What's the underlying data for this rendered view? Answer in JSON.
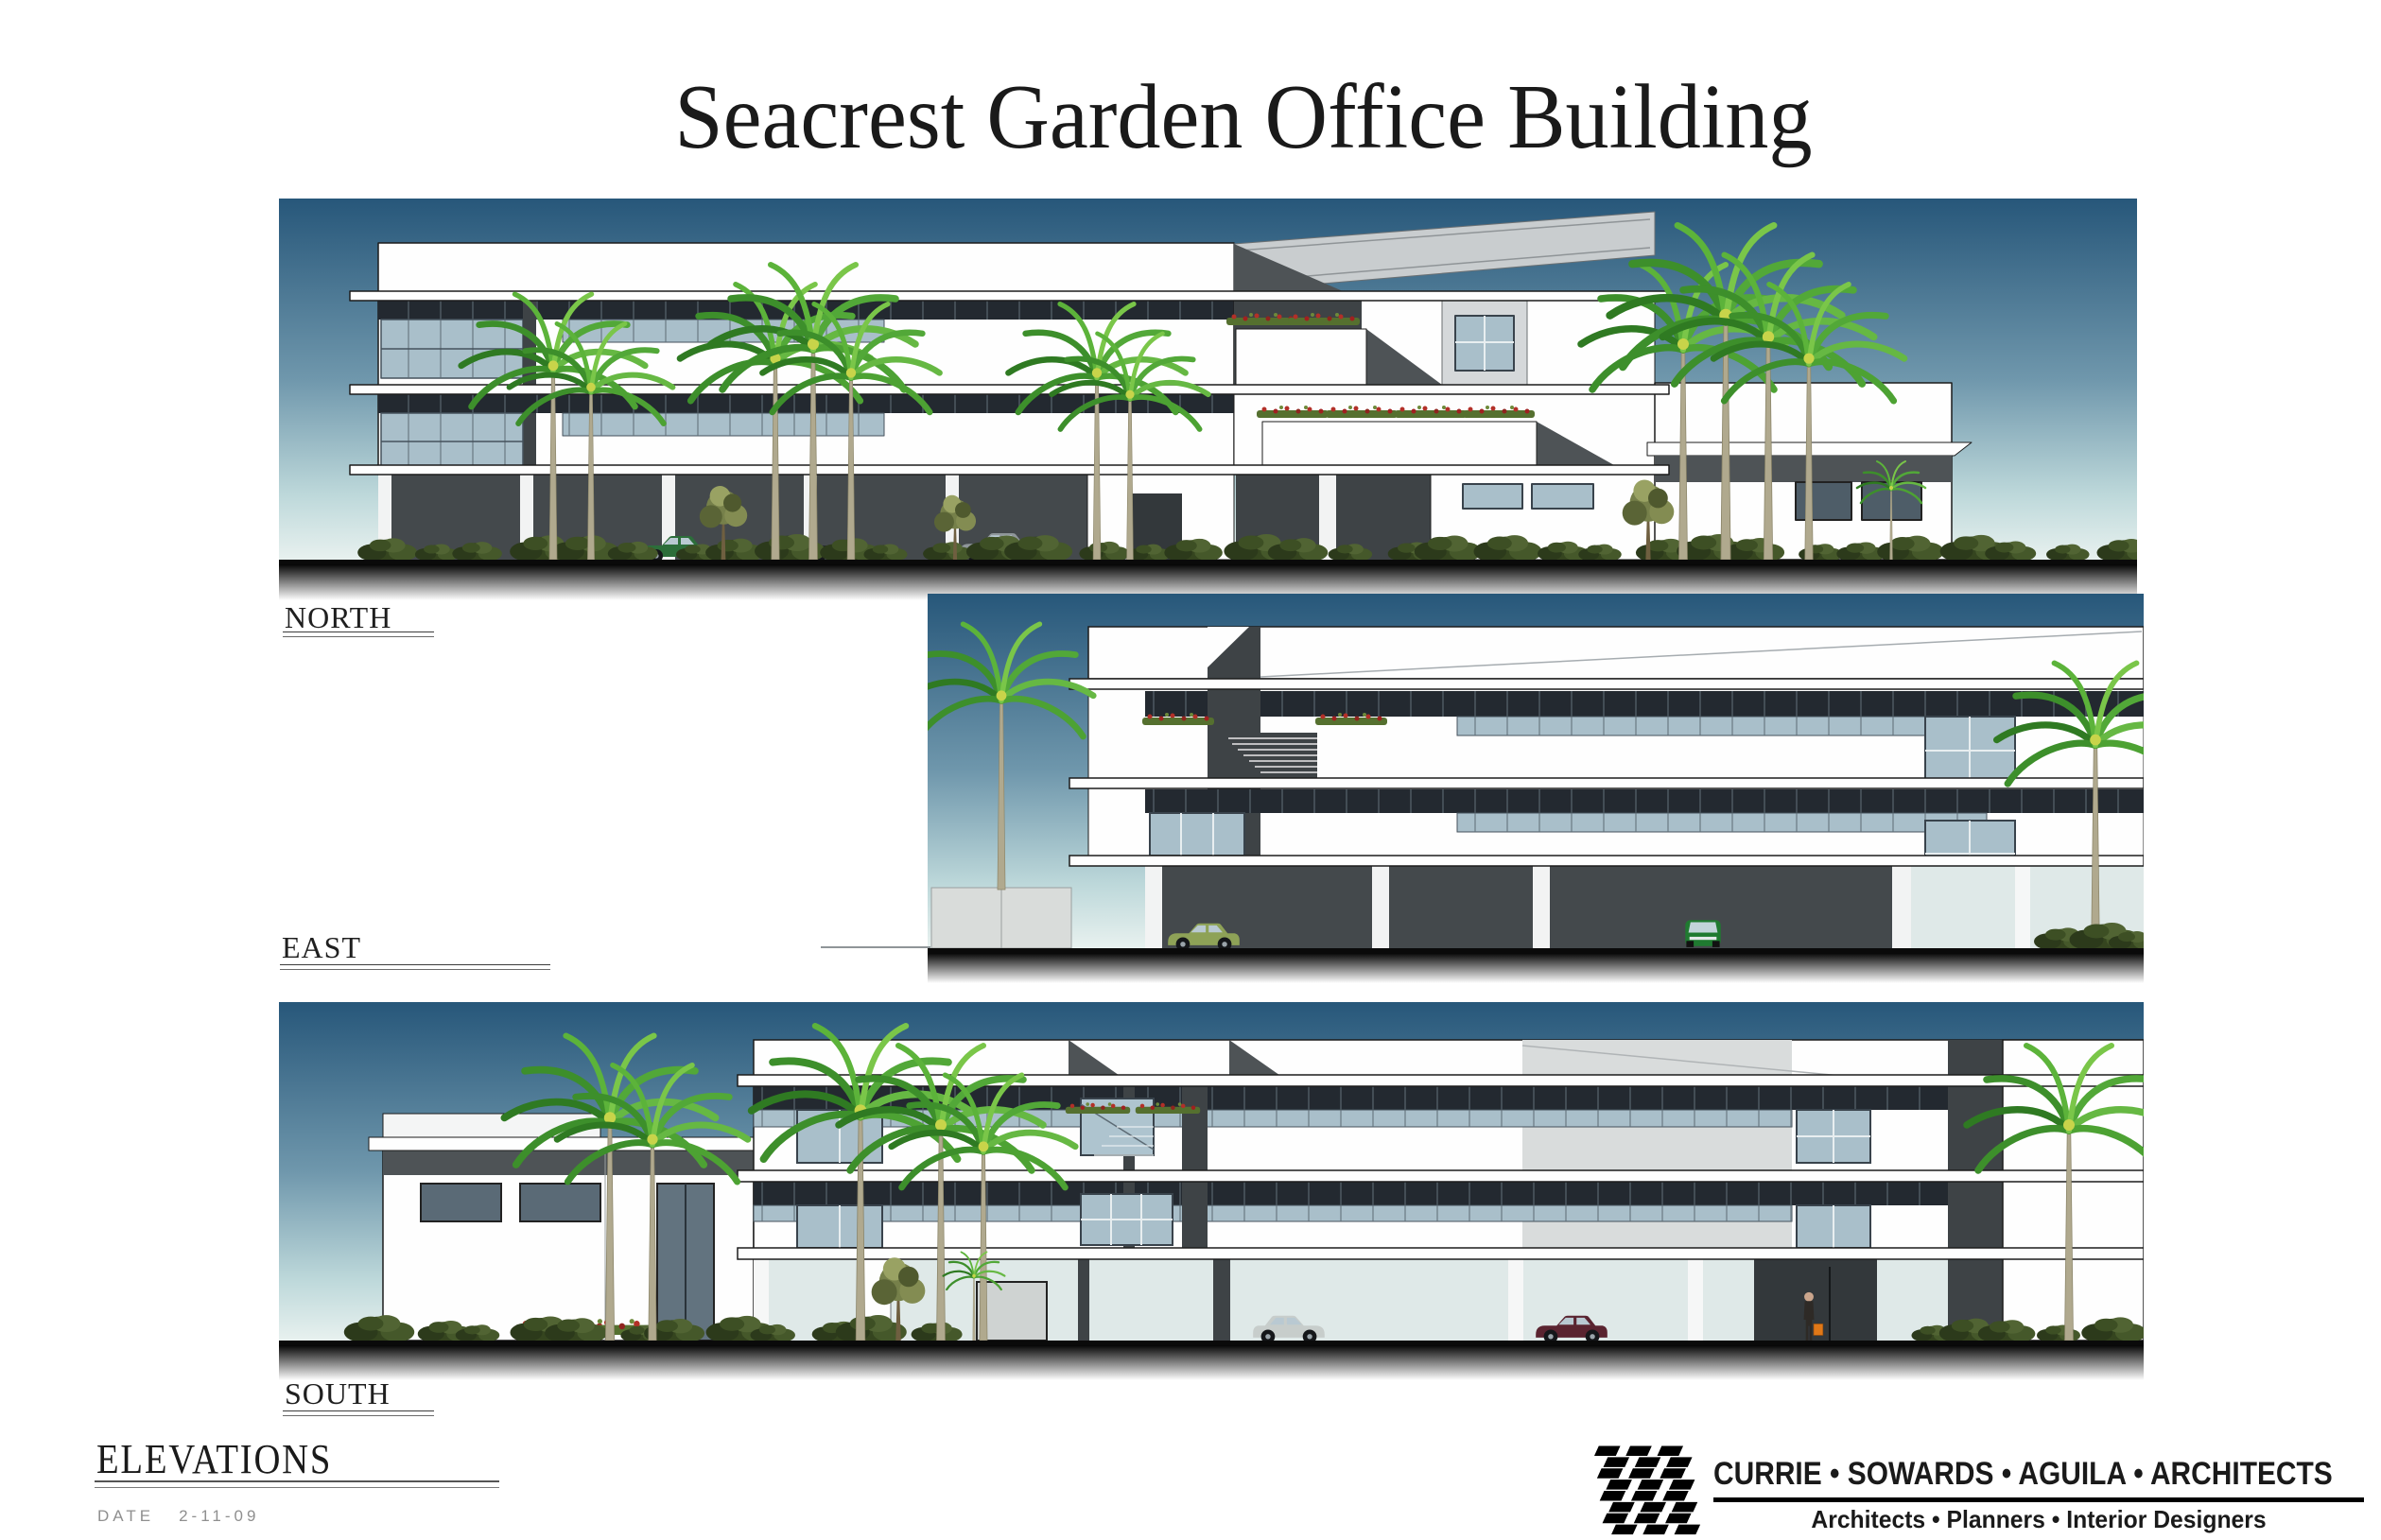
{
  "page": {
    "title": "Seacrest Garden Office Building"
  },
  "elevations": {
    "north": {
      "label": "NORTH"
    },
    "east": {
      "label": "EAST"
    },
    "south": {
      "label": "SOUTH"
    }
  },
  "titleblock": {
    "sheet_title": "ELEVATIONS",
    "date_label": "DATE",
    "date_value": "2-11-09"
  },
  "firm": {
    "logo_icon": "diagonal-checker-logo",
    "name": "CURRIE • SOWARDS • AGUILA • ARCHITECTS",
    "tagline": "Architects • Planners • Interior Designers"
  },
  "colors": {
    "sky_top": "#27577a",
    "sky_mid": "#6f97ac",
    "sky_low": "#bdd8da",
    "sky_horizon": "#e8f1ef",
    "ground_black": "#0a0a0a",
    "ribbon_dark": "#232930",
    "glass": "#a9bfca",
    "glass_light": "#dfe9e8",
    "core_dark": "#3e4346",
    "roof_light": "#c9cdcf",
    "roof_shadow": "#4e5356",
    "wall_white": "#fefefe",
    "wall_gray": "#d9dcdc",
    "logo_black": "#000000"
  }
}
